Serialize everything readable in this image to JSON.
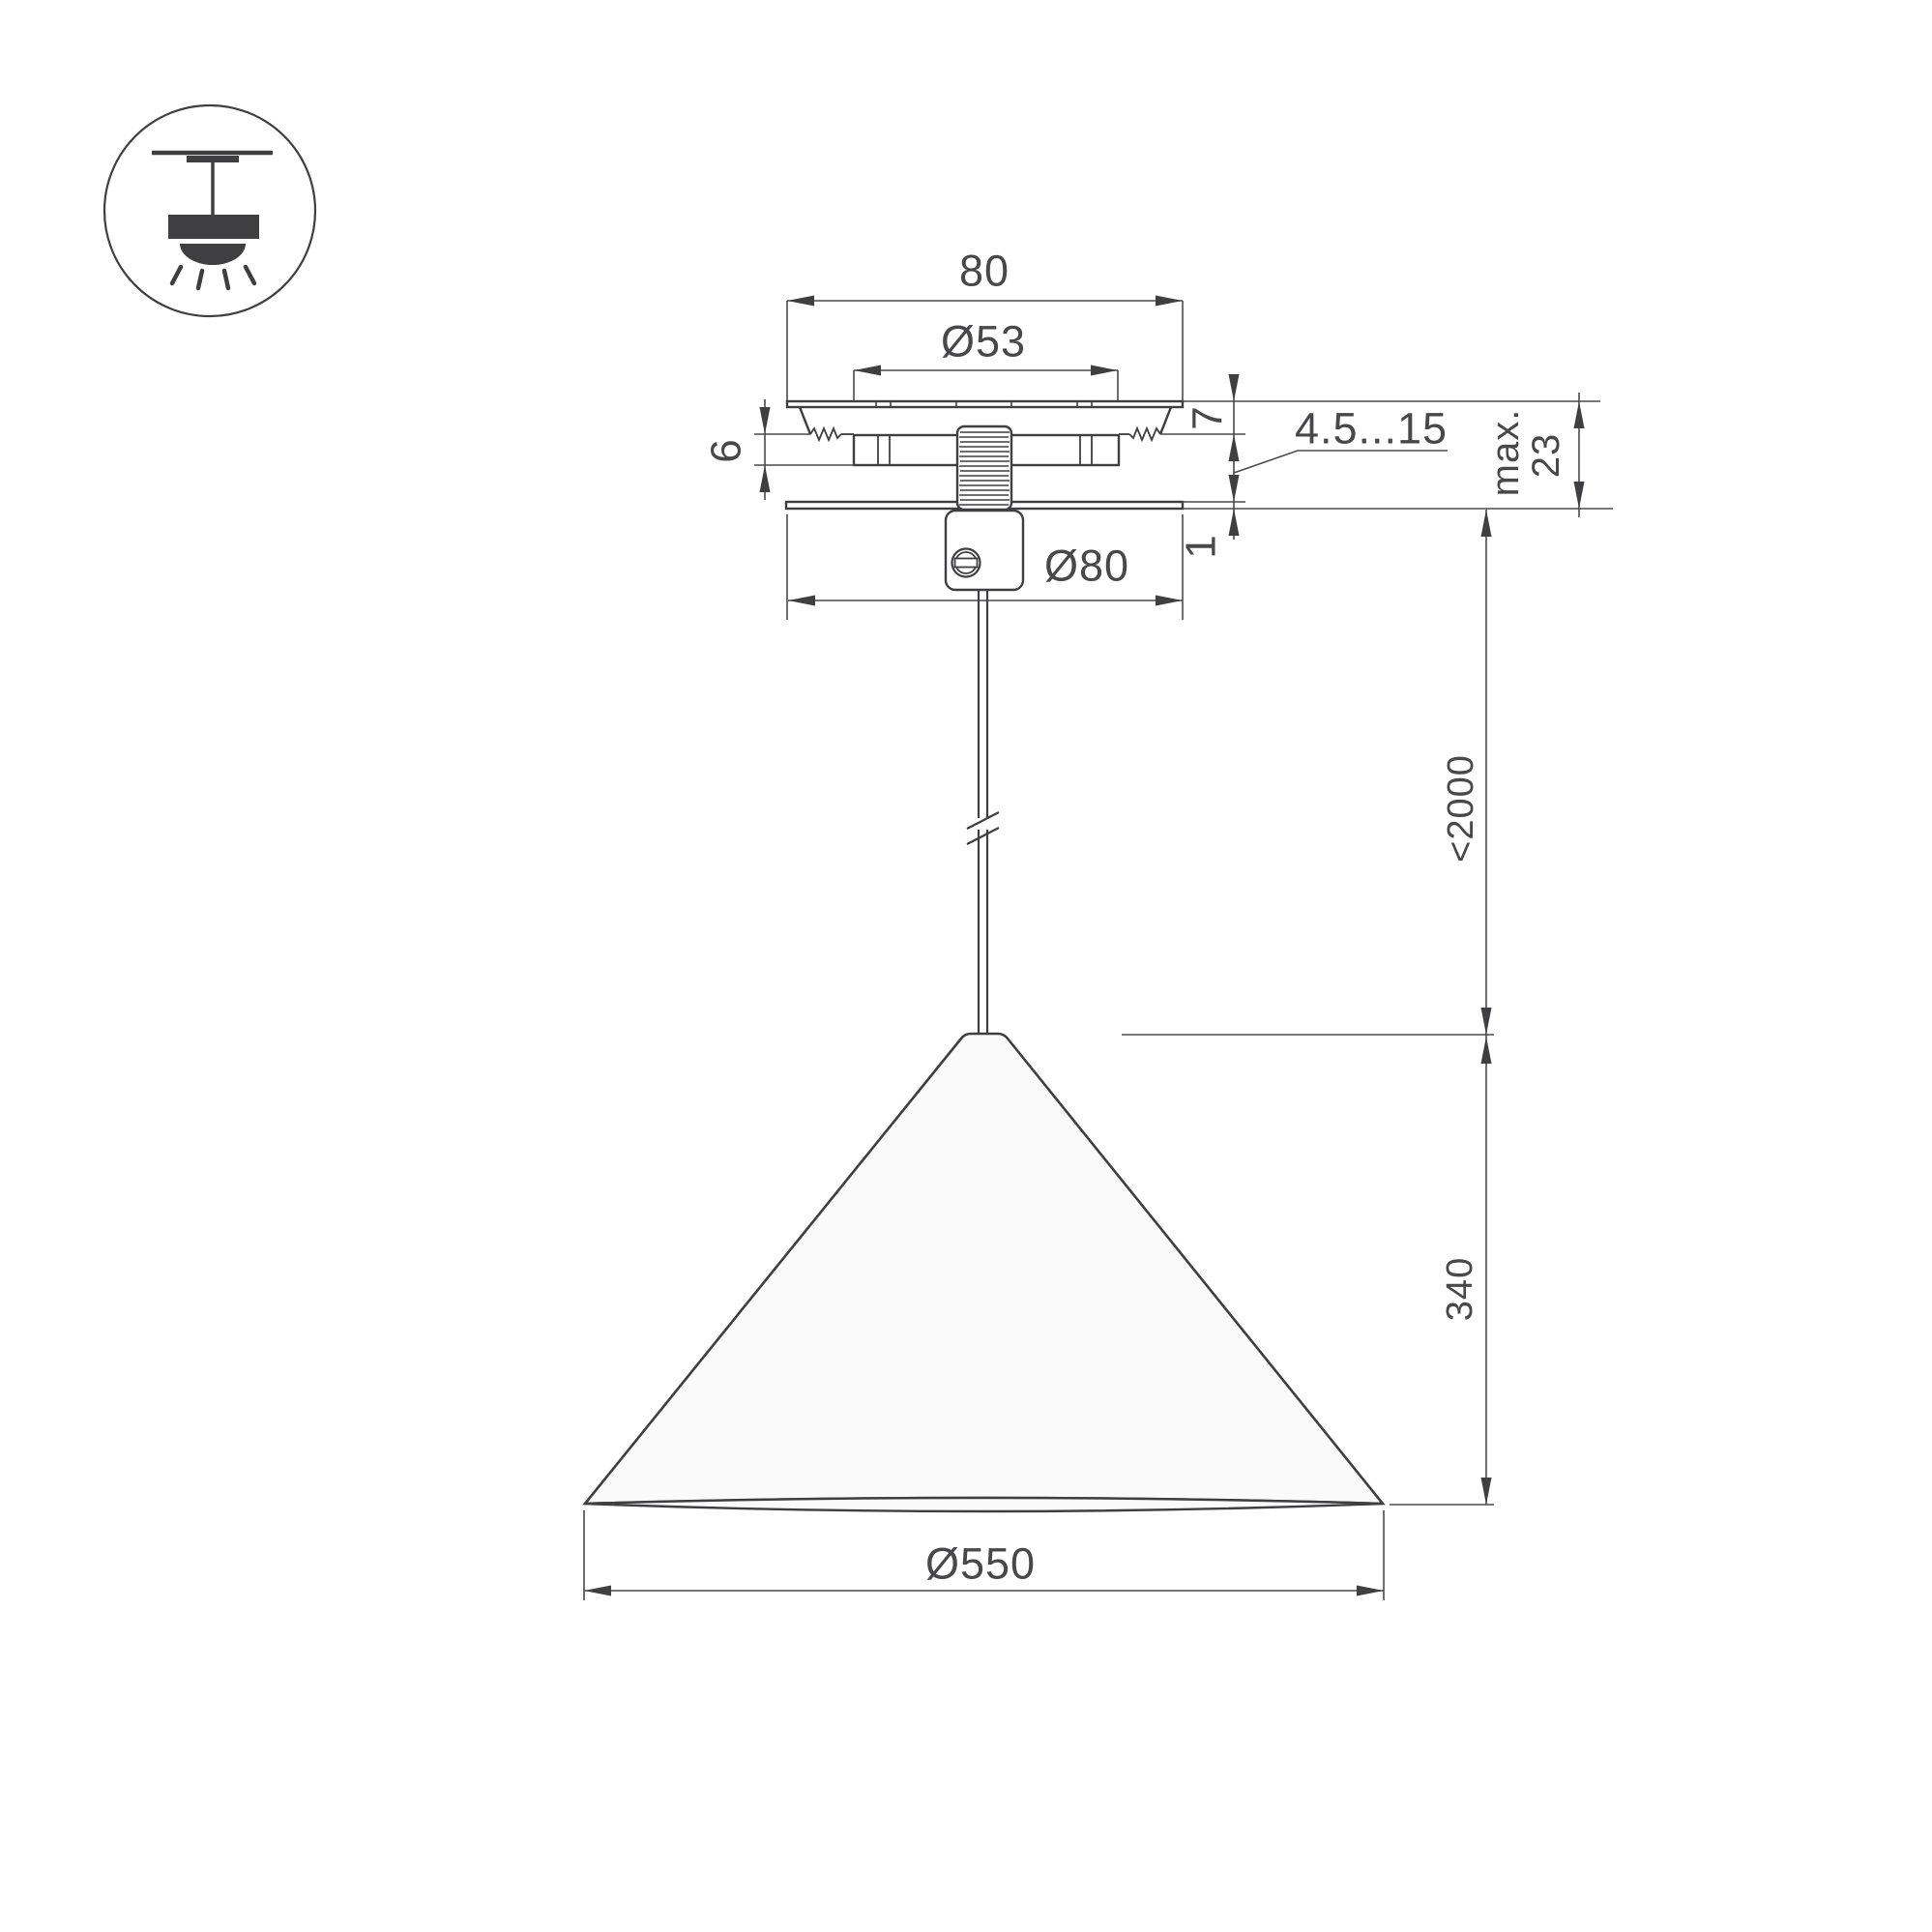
{
  "drawing": {
    "title": "pendant-lamp-dimension-drawing",
    "colors": {
      "line": "#3f3f41",
      "dimension_line": "#4a4a4d",
      "text": "#48484a",
      "shade_fill": "#fafafa",
      "background": "#ffffff"
    },
    "labels": {
      "canopy_width": "80",
      "hole_diameter": "Ø53",
      "canopy_plate_height": "7",
      "spring_block_height": "6",
      "ceiling_thickness_range": "4.5...15",
      "base_plate_thickness": "1",
      "max_depth_line1": "max.",
      "max_depth_line2": "23",
      "canopy_diameter": "Ø80",
      "cable_length": "<2000",
      "shade_height": "340",
      "shade_diameter": "Ø550"
    }
  }
}
